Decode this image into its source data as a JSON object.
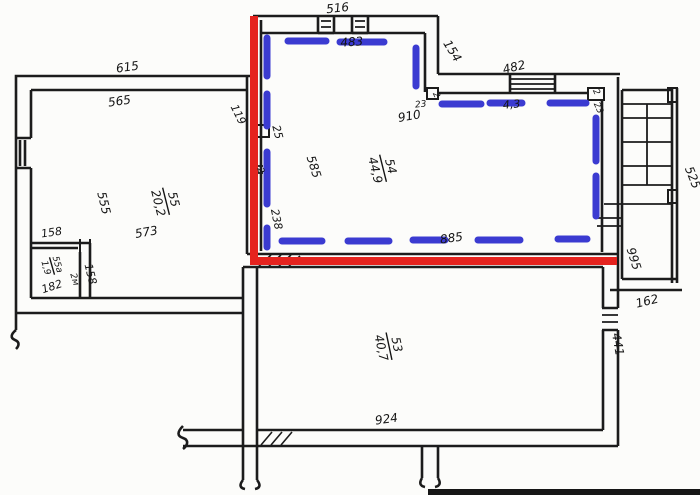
{
  "meta": {
    "type": "apartment-floor-plan",
    "style": "scanned hand-drawn BTI plan with red and blue marker annotations"
  },
  "colors": {
    "wall": "#1c1c1c",
    "highlight_red": "#e5231e",
    "highlight_blue": "#3b3bd1",
    "paper": "#fcfcfa"
  },
  "rooms": {
    "room55": {
      "number": "55",
      "area": "20,2"
    },
    "room55a": {
      "number": "55а",
      "area": "1,9",
      "height_note": "2м"
    },
    "room54": {
      "number": "54",
      "area": "44,9"
    },
    "room53": {
      "number": "53",
      "area": "40,7"
    }
  },
  "dims": {
    "d516": "516",
    "d615": "615",
    "d565": "565",
    "d119": "119",
    "d154": "154",
    "d483": "483",
    "d482": "482",
    "d43": "4,3",
    "d910": "910",
    "d23a": "23",
    "d2a": "2",
    "d2b": "2",
    "d23b": "23",
    "d25": "25",
    "d2c": "2",
    "d585": "585",
    "d238": "238",
    "d885": "885",
    "d555": "555",
    "d573": "573",
    "d158a": "158",
    "d158b": "158",
    "d182": "182",
    "d924": "924",
    "d995": "995",
    "d525": "525",
    "d162": "162",
    "d441": "441"
  }
}
